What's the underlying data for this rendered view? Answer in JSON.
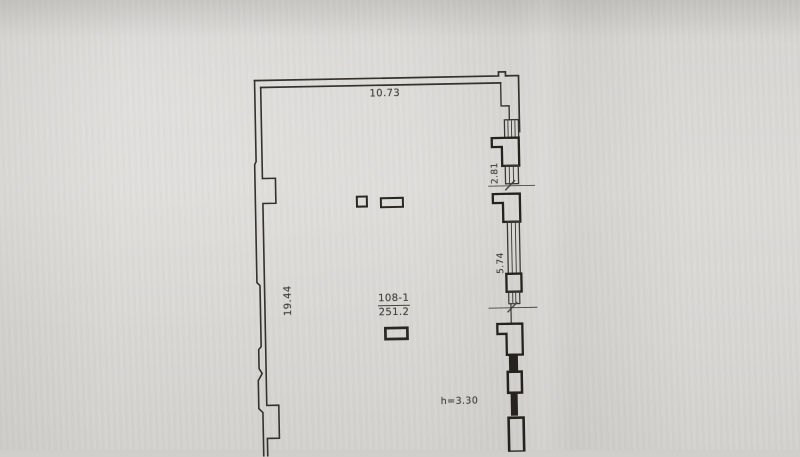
{
  "floor_plan": {
    "dim_top": "10.73",
    "dim_left": "19.44",
    "dim_right_upper": "2.81",
    "dim_right_mid": "5.74",
    "room_number": "108-1",
    "room_area": "251.2",
    "ceiling_height": "h=3.30"
  },
  "colors": {
    "paper": "#d7d6d3",
    "ink_line": "#36332e",
    "ink_text": "#46423c"
  }
}
